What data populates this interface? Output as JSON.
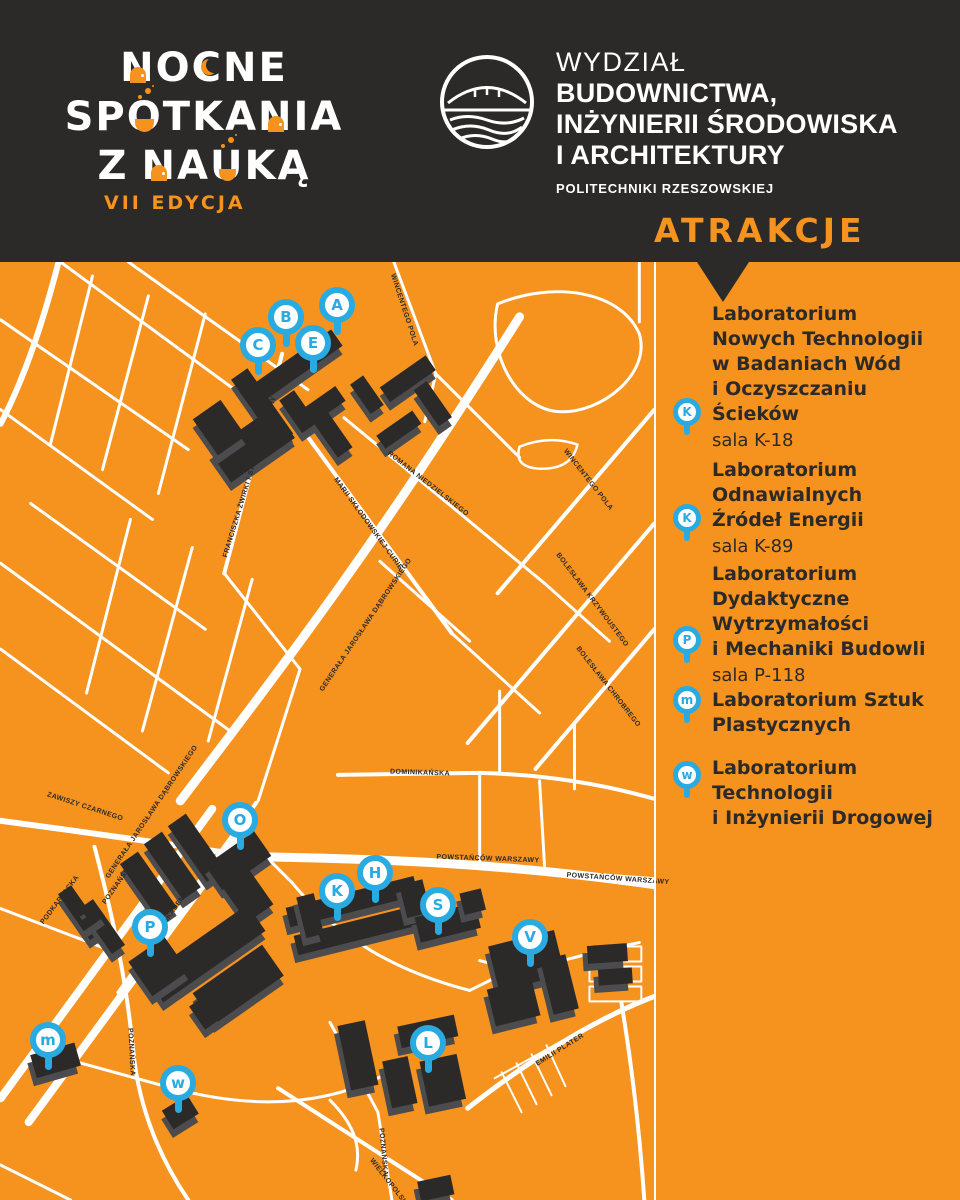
{
  "colors": {
    "background_orange": "#F6921E",
    "panel_dark": "#2B2A29",
    "marker_blue": "#29ABE2",
    "road_white": "#FFFFFF"
  },
  "header": {
    "wordmark_lines": [
      "NOCNE",
      "SPOTKANIA",
      "Z NAUKĄ"
    ],
    "edition": "VII EDYCJA",
    "faculty_lines": [
      "WYDZIAŁ",
      "BUDOWNICTWA,",
      "INŻYNIERII ŚRODOWISKA",
      "I ARCHITEKTURY",
      "POLITECHNIKI RZESZOWSKIEJ"
    ],
    "attractions_title": "ATRAKCJE"
  },
  "sidebar": {
    "items": [
      {
        "pin": "K",
        "title_lines": [
          "Laboratorium",
          "Nowych Technologii",
          "w Badaniach Wód",
          "i Oczyszczaniu",
          "Ścieków"
        ],
        "room": "sala K-18"
      },
      {
        "pin": "K",
        "title_lines": [
          "Laboratorium",
          "Odnawialnych",
          "Źródeł Energii"
        ],
        "room": "sala K-89"
      },
      {
        "pin": "P",
        "title_lines": [
          "Laboratorium",
          "Dydaktyczne",
          "Wytrzymałości",
          "i Mechaniki Budowli"
        ],
        "room": "sala P-118"
      },
      {
        "pin": "m",
        "title_lines": [
          "Laboratorium Sztuk",
          "Plastycznych"
        ],
        "room": ""
      },
      {
        "pin": "w",
        "title_lines": [
          "Laboratorium",
          "Technologii",
          "i Inżynierii Drogowej"
        ],
        "room": ""
      }
    ]
  },
  "map": {
    "markers": [
      {
        "letter": "A",
        "x": 337,
        "y": 43
      },
      {
        "letter": "B",
        "x": 286,
        "y": 55
      },
      {
        "letter": "E",
        "x": 313,
        "y": 81
      },
      {
        "letter": "C",
        "x": 258,
        "y": 83
      },
      {
        "letter": "O",
        "x": 240,
        "y": 558
      },
      {
        "letter": "H",
        "x": 375,
        "y": 611
      },
      {
        "letter": "K",
        "x": 337,
        "y": 629
      },
      {
        "letter": "S",
        "x": 438,
        "y": 643
      },
      {
        "letter": "V",
        "x": 530,
        "y": 675
      },
      {
        "letter": "P",
        "x": 150,
        "y": 665
      },
      {
        "letter": "m",
        "x": 48,
        "y": 778
      },
      {
        "letter": "w",
        "x": 178,
        "y": 821
      },
      {
        "letter": "L",
        "x": 428,
        "y": 781
      }
    ],
    "street_labels": [
      {
        "text": "FRANCISZKA ŻWIRKI I STANISŁAWA WIGURY",
        "x": 250,
        "y": 215,
        "rot": -73
      },
      {
        "text": "MARII SKŁODOWSKIEJ-CURIE",
        "x": 368,
        "y": 262,
        "rot": 54
      },
      {
        "text": "ROMANA NIEDZIELSKIEGO",
        "x": 428,
        "y": 222,
        "rot": 38
      },
      {
        "text": "WINCENTEGO POLA",
        "x": 404,
        "y": 48,
        "rot": 72
      },
      {
        "text": "WINCENTEGO POLA",
        "x": 588,
        "y": 218,
        "rot": 52
      },
      {
        "text": "BOLESŁAWA KRZYWOUSTEGO",
        "x": 592,
        "y": 338,
        "rot": 53
      },
      {
        "text": "BOLESŁAWA CHROBREGO",
        "x": 608,
        "y": 425,
        "rot": 52
      },
      {
        "text": "GENERAŁA JAROSŁAWA DĄBROWSKIEGO",
        "x": 366,
        "y": 363,
        "rot": -56
      },
      {
        "text": "GENERAŁA JAROSŁAWA DĄBROWSKIEGO",
        "x": 152,
        "y": 550,
        "rot": -56
      },
      {
        "text": "ZAWISZY CZARNEGO",
        "x": 85,
        "y": 545,
        "rot": 18
      },
      {
        "text": "PODKARPACKA",
        "x": 60,
        "y": 638,
        "rot": -53
      },
      {
        "text": "POZNAŃSKA",
        "x": 118,
        "y": 622,
        "rot": -55
      },
      {
        "text": "AKADEMICKA",
        "x": 180,
        "y": 640,
        "rot": -53
      },
      {
        "text": "POWSTAŃCÓW WARSZAWY",
        "x": 488,
        "y": 597,
        "rot": 2
      },
      {
        "text": "POWSTAŃCÓW WARSZAWY",
        "x": 618,
        "y": 617,
        "rot": 4
      },
      {
        "text": "DOMINIKAŃSKA",
        "x": 420,
        "y": 511,
        "rot": 2
      },
      {
        "text": "EMILII PLATER",
        "x": 560,
        "y": 788,
        "rot": -32
      },
      {
        "text": "POZNAŃSKA",
        "x": 131,
        "y": 790,
        "rot": 87
      },
      {
        "text": "POZNAŃSKA",
        "x": 383,
        "y": 890,
        "rot": 85
      },
      {
        "text": "WIELKOPOLSKA",
        "x": 390,
        "y": 922,
        "rot": 52
      }
    ]
  }
}
